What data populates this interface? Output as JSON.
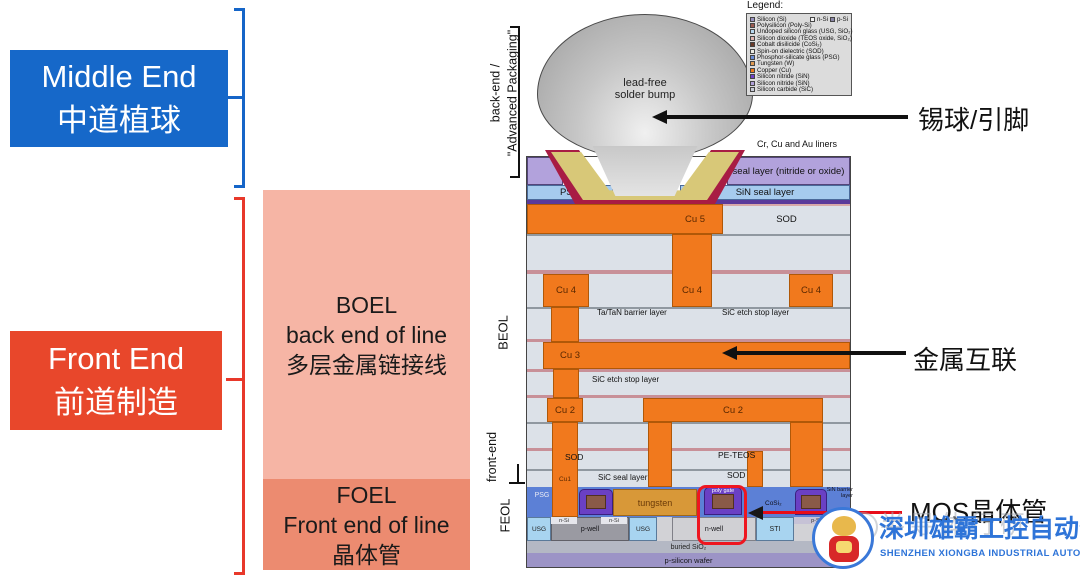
{
  "left_panel": {
    "middle_end": {
      "line1": "Middle End",
      "line2": "中道植球",
      "bg": "#1668C9"
    },
    "front_end": {
      "line1": "Front End",
      "line2": "前道制造",
      "bg": "#E8472B"
    },
    "boel": {
      "line1": "BOEL",
      "line2": "back end of line",
      "line3": "多层金属链接线",
      "bg": "#F6B5A5"
    },
    "foel": {
      "line1": "FOEL",
      "line2": "Front end of line",
      "line3": "晶体管",
      "bg": "#EC8B70"
    }
  },
  "side_labels": {
    "back_end_1": "back-end /",
    "back_end_2": "\"Advanced Packaging\"",
    "beol": "BEOL",
    "front_end": "front-end",
    "feol": "FEOL"
  },
  "callouts": {
    "solder": "锡球/引脚",
    "interconnect": "金属互联",
    "mos": "MOS晶体管"
  },
  "legend": {
    "title": "Legend:",
    "row1_extra": [
      {
        "label": "n-Si",
        "color": "#F2F2F2"
      },
      {
        "label": "p-Si",
        "color": "#8A86A8"
      }
    ],
    "items": [
      {
        "label": "Silicon (Si)",
        "color": "#9A92C2"
      },
      {
        "label": "Polysilicon (Poly-Si)",
        "color": "#9A5A50"
      },
      {
        "label": "Undoped silicon glass (USG, SiO₂)",
        "color": "#B8D8F0"
      },
      {
        "label": "Silicon dioxide (TEOS oxide, SiO₂)",
        "color": "#E0B4B0"
      },
      {
        "label": "Cobalt disilicide (CoSi₂)",
        "color": "#6A3A28"
      },
      {
        "label": "Spin-on dielectric (SOD)",
        "color": "#ECECE4"
      },
      {
        "label": "Phosphor-silicate glass (PSG)",
        "color": "#6A8CD8"
      },
      {
        "label": "Tungsten (W)",
        "color": "#E09A50"
      },
      {
        "label": "Copper (Cu)",
        "color": "#F07818"
      },
      {
        "label": "Silicon nitride (SiN)",
        "color": "#7040C8"
      },
      {
        "label": "Silicon nitride (SiN)",
        "color": "#B0A0D8"
      },
      {
        "label": "Silicon carbide (SiC)",
        "color": "#C8CCD8"
      }
    ]
  },
  "diagram": {
    "bump_line1": "lead-free",
    "bump_line2": "solder bump",
    "labels": {
      "cr_cu_au": "Cr, Cu and Au liners",
      "seal": "seal layer (nitride or oxide)",
      "psg_top": "PSG",
      "sin_seal": "SiN seal layer",
      "cu5": "Cu 5",
      "sod1": "SOD",
      "cu4a": "Cu 4",
      "cu4b": "Cu 4",
      "cu4c": "Cu 4",
      "tatan": "Ta/TaN barrier layer",
      "sic1": "SiC etch stop layer",
      "cu3": "Cu 3",
      "sic2": "SiC etch stop layer",
      "cu2a": "Cu 2",
      "cu2b": "Cu 2",
      "sod2": "SOD",
      "peteos": "PE-TEOS",
      "cu1": "Cu1",
      "sic_seal": "SiC seal layer",
      "sod3": "SOD",
      "psg2": "PSG",
      "tungsten": "tungsten",
      "poly_gate": "poly gate",
      "cosi2": "CoSi₂",
      "sin_barrier": "SiN barrier layer",
      "spacer": "spacer",
      "usg1": "USG",
      "pwell": "p-well",
      "usg2": "USG",
      "nwell": "n-well",
      "sti": "STI",
      "nsi1": "n-Si",
      "nsi2": "n-Si",
      "psi": "p-Si",
      "buried": "buried SiO₂",
      "wafer": "p-silicon wafer"
    }
  },
  "footer": {
    "watermark": "半导体行研",
    "company_cn": "深圳雄霸工控自动化",
    "company_en": "SHENZHEN XIONGBA INDUSTRIAL AUTOMATION",
    "brand_color": "#2E74D8"
  }
}
